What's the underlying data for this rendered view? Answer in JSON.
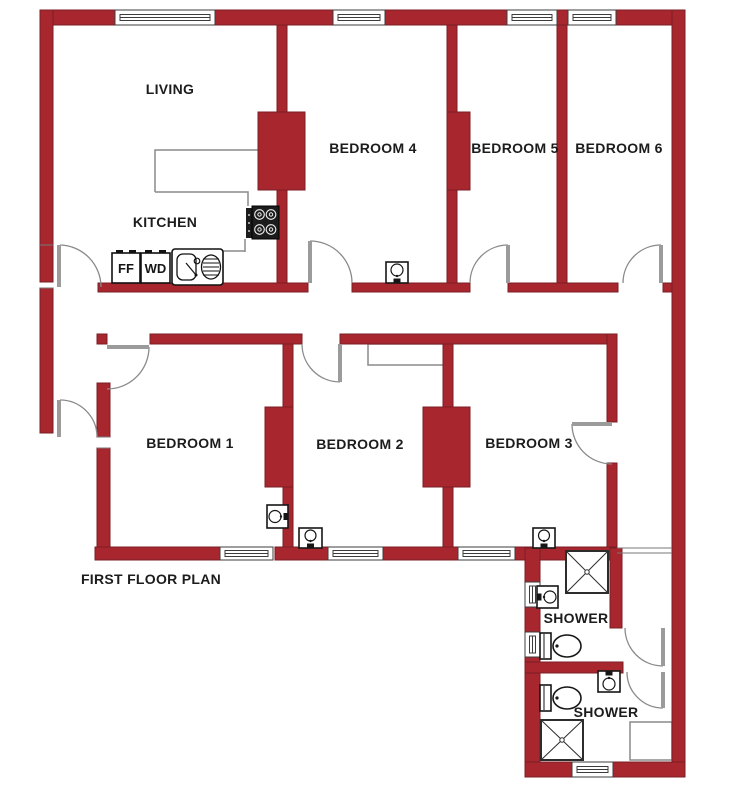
{
  "title": "FIRST FLOOR PLAN",
  "canvas": {
    "width": 743,
    "height": 800
  },
  "colors": {
    "wall": "#a8272f",
    "wall_border": "#7b1d24",
    "door_line": "#8a8a8a",
    "door_leaf": "#9b9b9b",
    "fixture_line": "#161616",
    "counter_line": "#8a8a8a",
    "window_line": "#3c3c3c",
    "text": "#1c1c1c",
    "background": "#ffffff"
  },
  "plan": {
    "walls": [
      [
        40,
        10,
        75,
        15
      ],
      [
        215,
        10,
        118,
        15
      ],
      [
        385,
        10,
        122,
        15
      ],
      [
        557,
        10,
        11,
        15
      ],
      [
        616,
        10,
        69,
        15
      ],
      [
        40,
        10,
        13,
        272
      ],
      [
        40,
        288,
        13,
        145
      ],
      [
        672,
        10,
        13,
        753
      ],
      [
        98,
        283,
        210,
        9
      ],
      [
        352,
        283,
        118,
        9
      ],
      [
        508,
        283,
        110,
        9
      ],
      [
        663,
        283,
        9,
        9
      ],
      [
        277,
        25,
        10,
        258
      ],
      [
        258,
        112,
        47,
        78
      ],
      [
        447,
        25,
        10,
        258
      ],
      [
        447,
        112,
        23,
        78
      ],
      [
        557,
        25,
        10,
        258
      ],
      [
        97,
        334,
        10,
        10
      ],
      [
        150,
        334,
        152,
        10
      ],
      [
        340,
        334,
        275,
        10
      ],
      [
        607,
        334,
        10,
        88
      ],
      [
        607,
        463,
        10,
        84
      ],
      [
        97,
        383,
        13,
        54
      ],
      [
        97,
        448,
        13,
        110
      ],
      [
        283,
        344,
        10,
        203
      ],
      [
        265,
        407,
        28,
        80
      ],
      [
        443,
        344,
        10,
        203
      ],
      [
        423,
        407,
        47,
        80
      ],
      [
        95,
        547,
        125,
        13
      ],
      [
        275,
        547,
        53,
        13
      ],
      [
        383,
        547,
        75,
        13
      ],
      [
        515,
        547,
        102,
        13
      ],
      [
        525,
        548,
        15,
        34
      ],
      [
        525,
        607,
        15,
        25
      ],
      [
        525,
        657,
        15,
        120
      ],
      [
        525,
        762,
        47,
        15
      ],
      [
        613,
        762,
        72,
        15
      ],
      [
        525,
        662,
        98,
        11
      ],
      [
        610,
        548,
        12,
        80
      ]
    ],
    "windows": [
      {
        "x": 115,
        "y": 10,
        "w": 100,
        "h": 15,
        "o": "h"
      },
      {
        "x": 333,
        "y": 10,
        "w": 52,
        "h": 15,
        "o": "h"
      },
      {
        "x": 507,
        "y": 10,
        "w": 50,
        "h": 15,
        "o": "h"
      },
      {
        "x": 568,
        "y": 10,
        "w": 48,
        "h": 15,
        "o": "h"
      },
      {
        "x": 220,
        "y": 547,
        "w": 53,
        "h": 13,
        "o": "h"
      },
      {
        "x": 328,
        "y": 547,
        "w": 55,
        "h": 13,
        "o": "h"
      },
      {
        "x": 458,
        "y": 547,
        "w": 57,
        "h": 13,
        "o": "h"
      },
      {
        "x": 525,
        "y": 582,
        "w": 15,
        "h": 25,
        "o": "v"
      },
      {
        "x": 525,
        "y": 632,
        "w": 15,
        "h": 25,
        "o": "v"
      },
      {
        "x": 572,
        "y": 762,
        "w": 41,
        "h": 15,
        "o": "h"
      }
    ],
    "doors": [
      {
        "n": "kitchen-door",
        "f": [
          60,
          245
        ],
        "t": [
          101,
          287
        ],
        "r": 42,
        "s": 1,
        "leaf": [
          59,
          287,
          59,
          245
        ]
      },
      {
        "n": "entrance-door",
        "f": [
          60,
          400
        ],
        "t": [
          97,
          437
        ],
        "r": 37,
        "s": 1,
        "leaf": [
          59,
          437,
          59,
          400
        ]
      },
      {
        "n": "bedroom1-door",
        "f": [
          149,
          347
        ],
        "t": [
          107,
          389
        ],
        "r": 42,
        "s": 1,
        "leaf": [
          107,
          347,
          149,
          347
        ]
      },
      {
        "n": "bedroom2-door",
        "f": [
          302,
          344
        ],
        "t": [
          340,
          382
        ],
        "r": 38,
        "s": 0,
        "leaf": [
          340,
          344,
          340,
          382
        ]
      },
      {
        "n": "bedroom4-door",
        "f": [
          310,
          241
        ],
        "t": [
          352,
          283
        ],
        "r": 42,
        "s": 1,
        "leaf": [
          310,
          283,
          310,
          241
        ]
      },
      {
        "n": "bedroom5-door",
        "f": [
          470,
          283
        ],
        "t": [
          508,
          245
        ],
        "r": 38,
        "s": 1,
        "leaf": [
          508,
          245,
          508,
          283
        ]
      },
      {
        "n": "bedroom6-door",
        "f": [
          623,
          283
        ],
        "t": [
          661,
          245
        ],
        "r": 38,
        "s": 1,
        "leaf": [
          661,
          245,
          661,
          283
        ]
      },
      {
        "n": "bedroom3-door",
        "f": [
          572,
          424
        ],
        "t": [
          612,
          464
        ],
        "r": 40,
        "s": 0,
        "leaf": [
          572,
          424,
          612,
          424
        ]
      },
      {
        "n": "shower1-door",
        "f": [
          625,
          628
        ],
        "t": [
          663,
          666
        ],
        "r": 38,
        "s": 0,
        "leaf": [
          663,
          628,
          663,
          666
        ]
      },
      {
        "n": "shower2-door",
        "f": [
          627,
          672
        ],
        "t": [
          663,
          708
        ],
        "r": 36,
        "s": 0,
        "leaf": [
          663,
          672,
          663,
          708
        ]
      }
    ],
    "jamb_lines": [
      [
        40,
        245,
        53,
        245
      ],
      [
        40,
        288,
        53,
        288
      ],
      [
        97,
        437,
        110,
        437
      ],
      [
        97,
        448,
        110,
        448
      ],
      [
        617,
        548,
        672,
        548
      ],
      [
        617,
        553,
        672,
        553
      ]
    ],
    "counter_paths": [
      "M155 192 L155 150 L258 150",
      "M155 192 L248 192 L248 206",
      "M245 239 L245 252",
      "M222 251 L245 251"
    ],
    "outline_boxes": [
      {
        "x": 368,
        "y": 344,
        "w": 79,
        "h": 21,
        "n": "bedroom2-closet"
      },
      {
        "x": 630,
        "y": 722,
        "w": 42,
        "h": 38,
        "n": "shower2-unit"
      }
    ],
    "stove": {
      "x": 246,
      "y": 206
    },
    "appliances": [
      {
        "x": 112,
        "y": 253,
        "w": 28,
        "h": 30,
        "label": "FF"
      },
      {
        "x": 141,
        "y": 253,
        "w": 29,
        "h": 30,
        "label": "WD"
      }
    ],
    "sink": {
      "x": 172,
      "y": 249,
      "w": 51,
      "h": 36
    },
    "basins": [
      {
        "x": 386,
        "y": 262,
        "w": 22,
        "h": 21,
        "tap": "bottom",
        "n": "bedroom4-basin"
      },
      {
        "x": 267,
        "y": 505,
        "w": 21,
        "h": 23,
        "tap": "right",
        "n": "bedroom1-basin"
      },
      {
        "x": 299,
        "y": 528,
        "w": 23,
        "h": 20,
        "tap": "bottom",
        "n": "bedroom2-basin"
      },
      {
        "x": 533,
        "y": 528,
        "w": 22,
        "h": 20,
        "tap": "bottom",
        "n": "bedroom3-basin"
      },
      {
        "x": 537,
        "y": 586,
        "w": 21,
        "h": 22,
        "tap": "left",
        "n": "shower1-basin"
      },
      {
        "x": 598,
        "y": 671,
        "w": 22,
        "h": 21,
        "tap": "top",
        "n": "shower2-basin"
      }
    ],
    "toilets": [
      {
        "x": 540,
        "y": 633,
        "n": "shower1-toilet"
      },
      {
        "x": 540,
        "y": 685,
        "n": "shower2-toilet"
      }
    ],
    "shower_trays": [
      {
        "x": 566,
        "y": 551,
        "w": 42,
        "h": 42,
        "n": "shower1-tray"
      },
      {
        "x": 541,
        "y": 720,
        "w": 42,
        "h": 40,
        "n": "shower2-tray"
      }
    ],
    "labels": [
      {
        "id": "living",
        "text": "LIVING",
        "x": 170,
        "y": 89
      },
      {
        "id": "kitchen",
        "text": "KITCHEN",
        "x": 165,
        "y": 222
      },
      {
        "id": "bedroom4",
        "text": "BEDROOM 4",
        "x": 373,
        "y": 148
      },
      {
        "id": "bedroom5",
        "text": "BEDROOM 5",
        "x": 515,
        "y": 148
      },
      {
        "id": "bedroom6",
        "text": "BEDROOM 6",
        "x": 619,
        "y": 148
      },
      {
        "id": "bedroom1",
        "text": "BEDROOM 1",
        "x": 190,
        "y": 443
      },
      {
        "id": "bedroom2",
        "text": "BEDROOM 2",
        "x": 360,
        "y": 444
      },
      {
        "id": "bedroom3",
        "text": "BEDROOM 3",
        "x": 529,
        "y": 443
      },
      {
        "id": "shower1",
        "text": "SHOWER",
        "x": 576,
        "y": 618
      },
      {
        "id": "shower2",
        "text": "SHOWER",
        "x": 606,
        "y": 712
      },
      {
        "id": "plan-title",
        "text": "FIRST FLOOR PLAN",
        "x": 151,
        "y": 579
      }
    ]
  }
}
